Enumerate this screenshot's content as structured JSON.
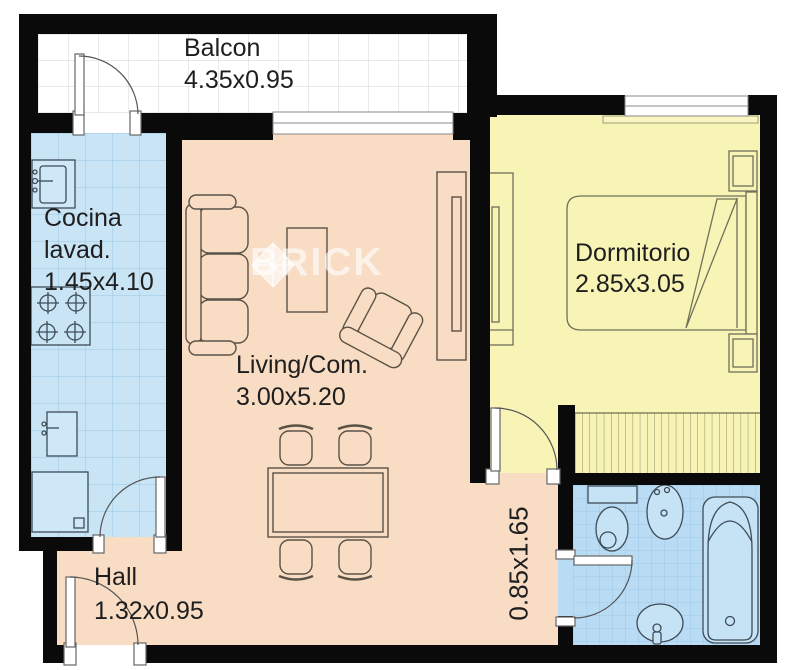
{
  "plan": {
    "title": "apartment-floor-plan",
    "watermark_text": "BRICK",
    "rooms": {
      "balcon": {
        "name": "Balcon",
        "dims": "4.35x0.95"
      },
      "cocina": {
        "name": "Cocina",
        "name2": "lavad.",
        "dims": "1.45x4.10"
      },
      "living": {
        "name": "Living/Com.",
        "dims": "3.00x5.20"
      },
      "dormitorio": {
        "name": "Dormitorio",
        "dims": "2.85x3.05"
      },
      "hall": {
        "name": "Hall",
        "dims": "1.32x0.95"
      },
      "pasillo": {
        "dims": "0.85x1.65"
      }
    },
    "colors": {
      "wall": "#0a0a0a",
      "living_floor": "#f8dcc4",
      "bedroom_floor": "#f7f4b6",
      "kitchen_floor": "#c9e4f5",
      "bathroom_floor": "#b9dcf4",
      "balcony_floor": "#ffffff",
      "kitchen_grid": "#96c6e2",
      "bathroom_grid": "#93c2e5",
      "balcony_grid": "#d5d5d5",
      "label_text": "#1e1e1e",
      "watermark": "rgba(255,255,255,0.62)"
    }
  }
}
